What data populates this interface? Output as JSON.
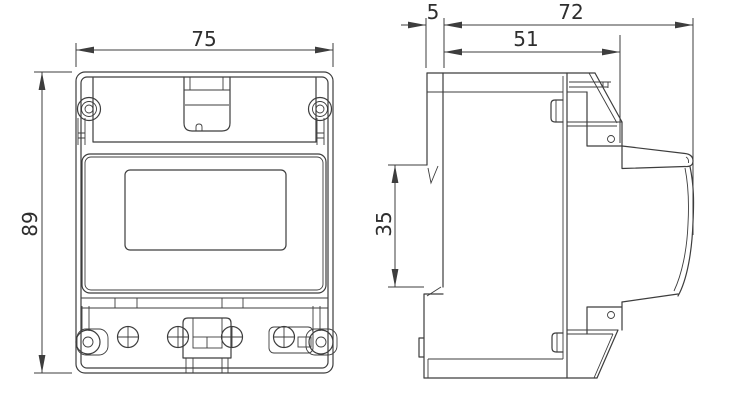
{
  "drawing": {
    "title": "energy-meter-dimension-drawing",
    "units": "mm",
    "front_view": {
      "width_label": "75",
      "height_label": "89"
    },
    "side_view": {
      "clip_depth_label": "5",
      "total_depth_label": "72",
      "body_depth_label": "51",
      "din_slot_height_label": "35"
    },
    "colors": {
      "line": "#3d3d3d",
      "text": "#2e2e2e",
      "background": "#ffffff"
    }
  }
}
